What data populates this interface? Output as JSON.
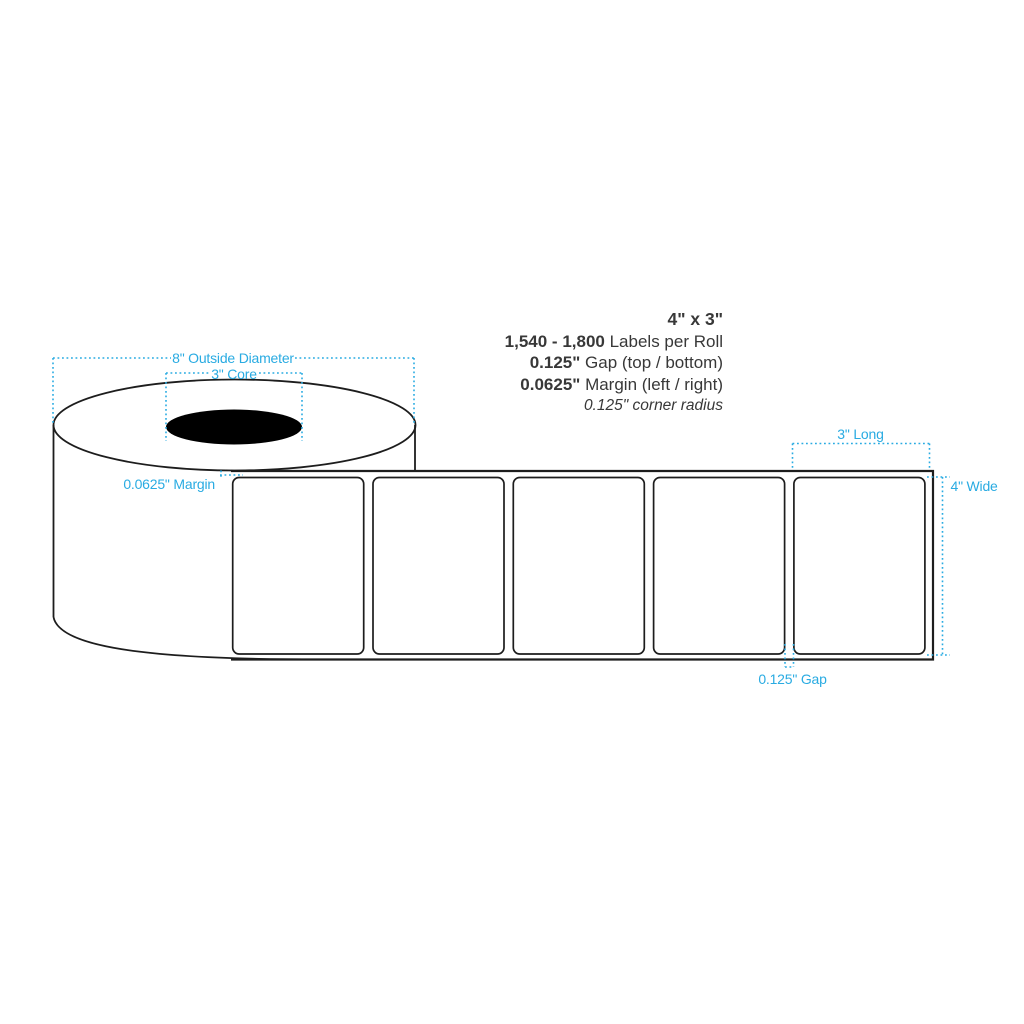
{
  "specs": {
    "size": "4\" x 3\"",
    "count_value": "1,540 - 1,800",
    "count_label": " Labels per Roll",
    "gap_value": "0.125\"",
    "gap_label": " Gap (top / bottom)",
    "margin_value": "0.0625\"",
    "margin_label": " Margin (left / right)",
    "corner_radius_note": "0.125\" corner radius"
  },
  "dimension_labels": {
    "outside_diameter": "8\" Outside Diameter",
    "core": "3\" Core",
    "side_margin": "0.0625\" Margin",
    "label_length": "3\" Long",
    "label_width": "4\" Wide",
    "label_gap": "0.125\" Gap"
  },
  "diagram": {
    "label_count": 5,
    "colors": {
      "dimension_blue": "#29ABE2",
      "outline": "#1d1d1d",
      "core_fill": "#000000",
      "spec_text": "#383838"
    }
  }
}
